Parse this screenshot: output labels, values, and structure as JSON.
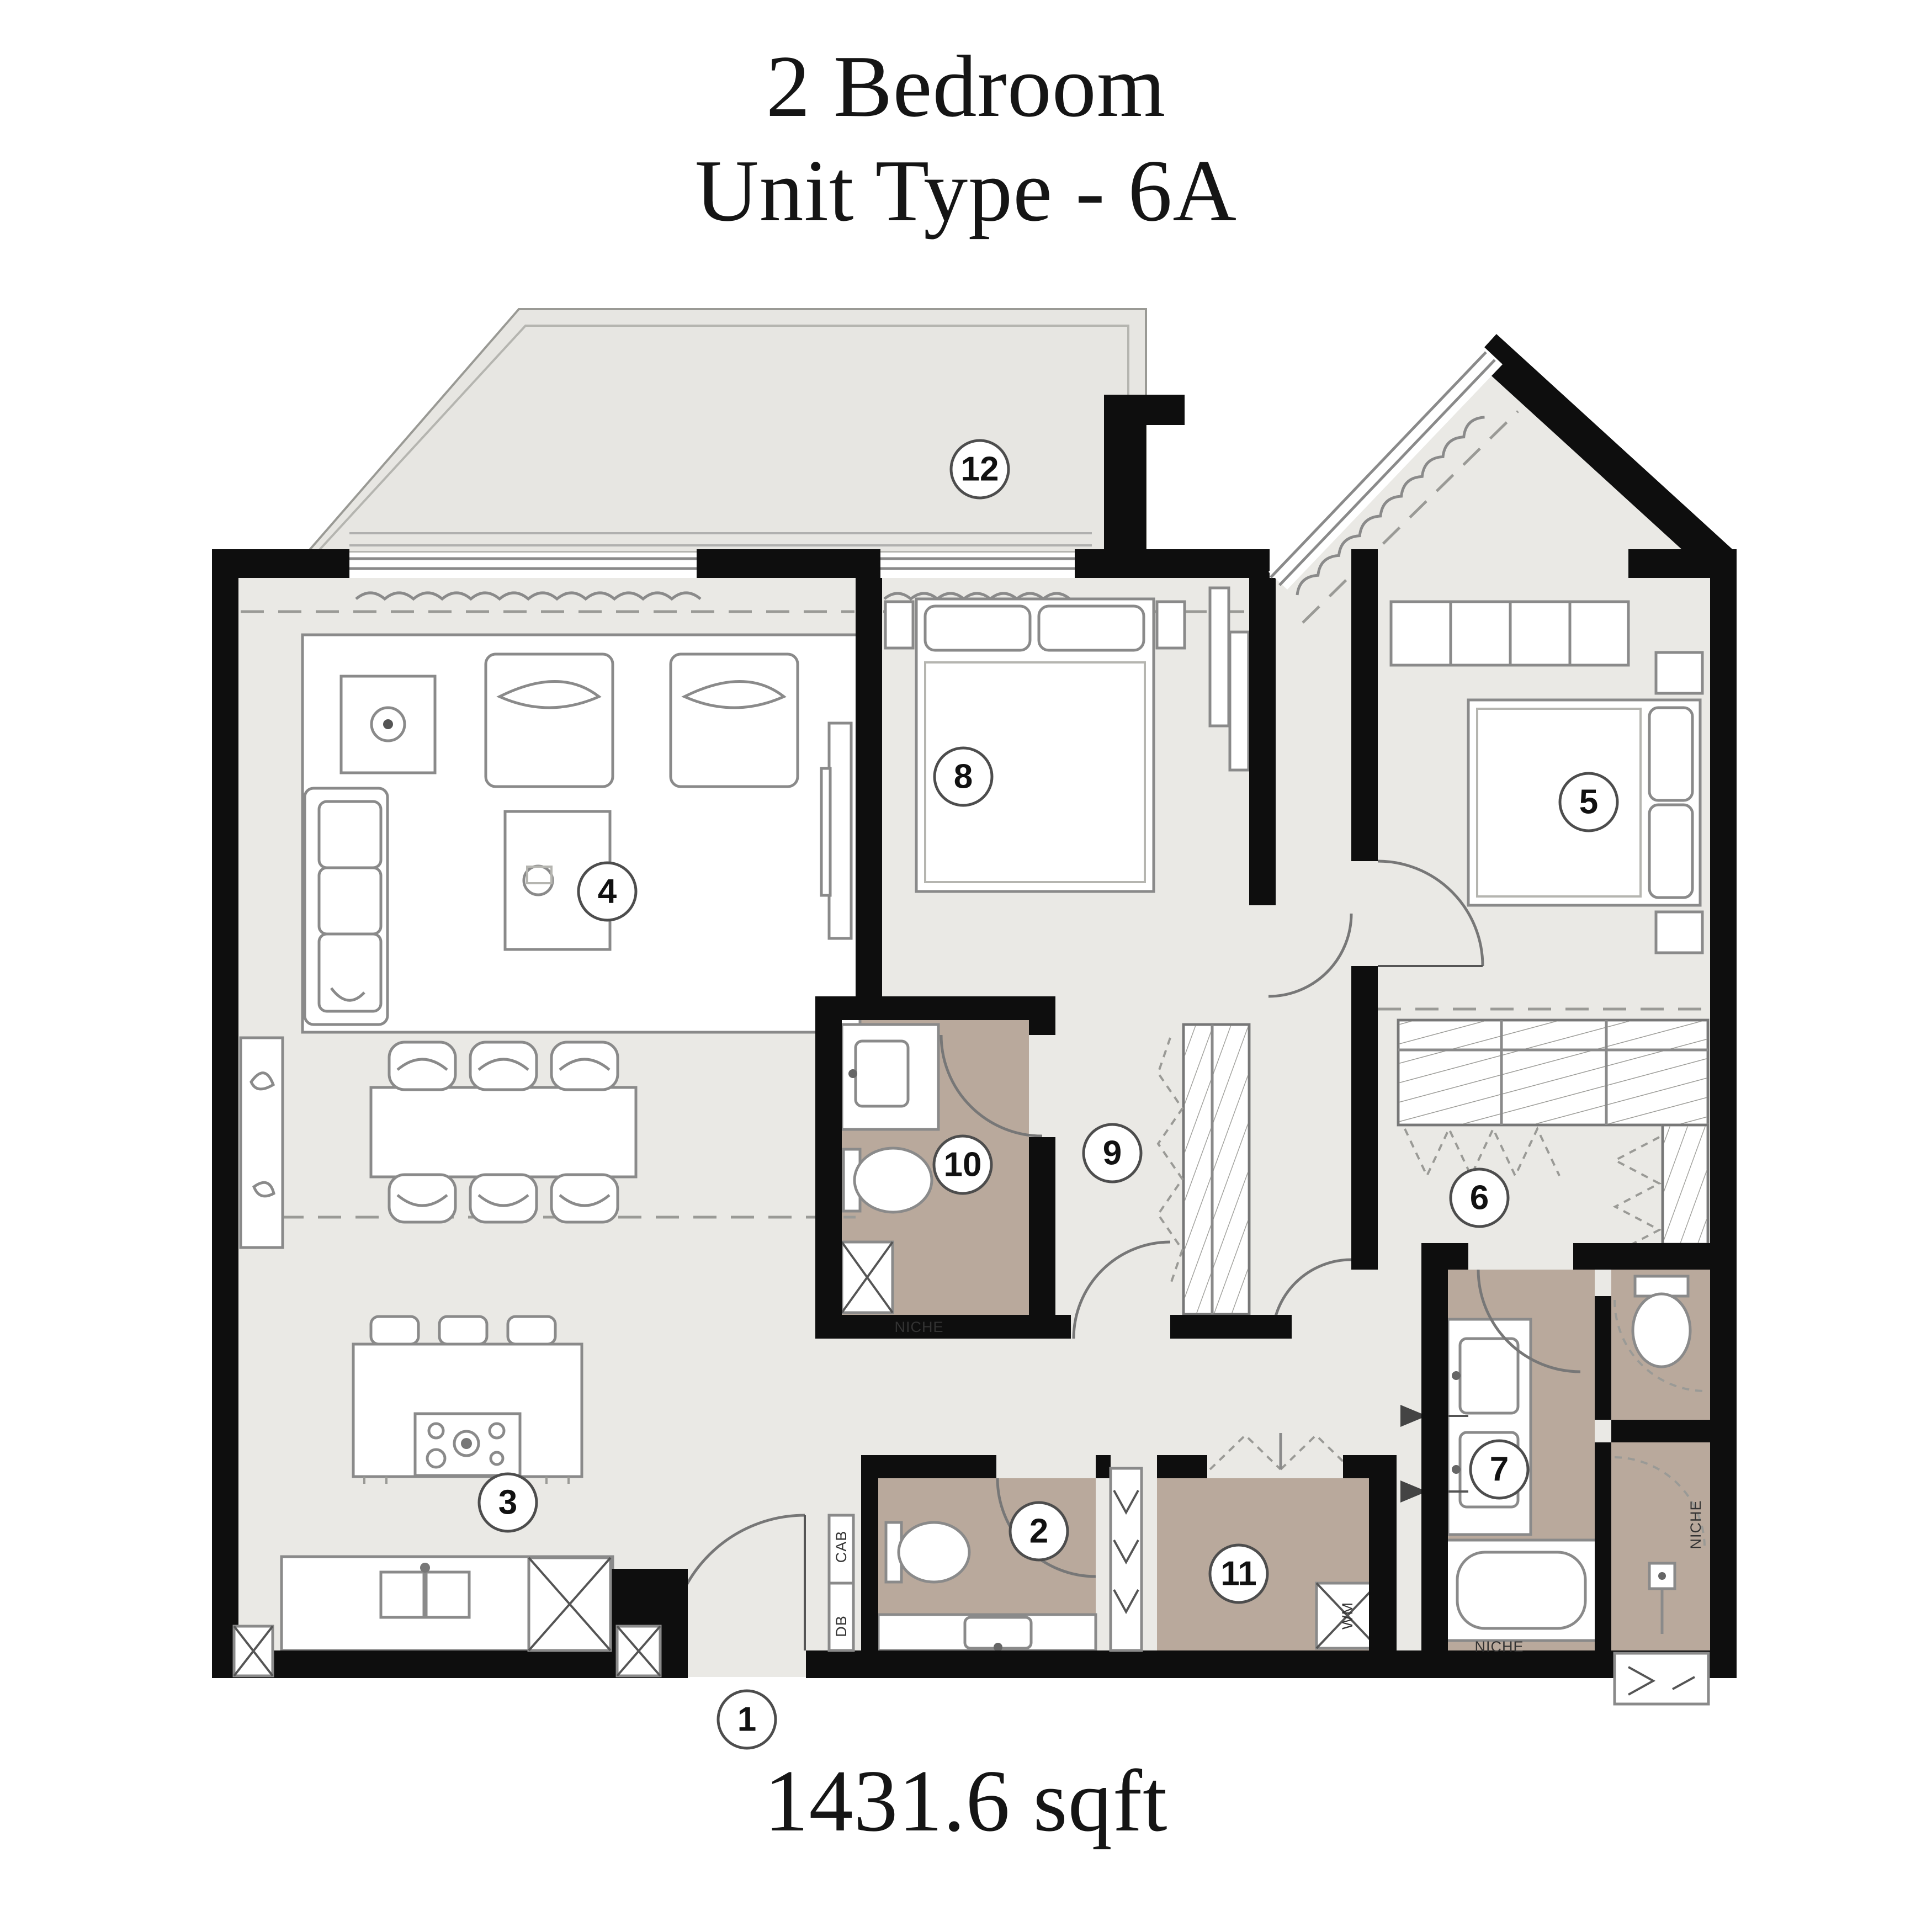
{
  "title": {
    "line1": "2 Bedroom",
    "line2": "Unit Type - 6A"
  },
  "area_label": "1431.6 sqft",
  "plan": {
    "room_badges": [
      "1",
      "2",
      "3",
      "4",
      "5",
      "6",
      "7",
      "8",
      "9",
      "10",
      "11",
      "12"
    ],
    "labels": {
      "niche_bath": "NICHE",
      "niche_tub": "NICHE",
      "niche_wc": "NICHE",
      "washer": "WM",
      "cab": "CAB",
      "db": "DB"
    },
    "colors": {
      "wall": "#0e0e0e",
      "floor": "#eae9e5",
      "balcony_floor": "#e7e6e2",
      "bathroom_floor": "#b9a99c",
      "detail_line": "#8a8a8a"
    }
  }
}
